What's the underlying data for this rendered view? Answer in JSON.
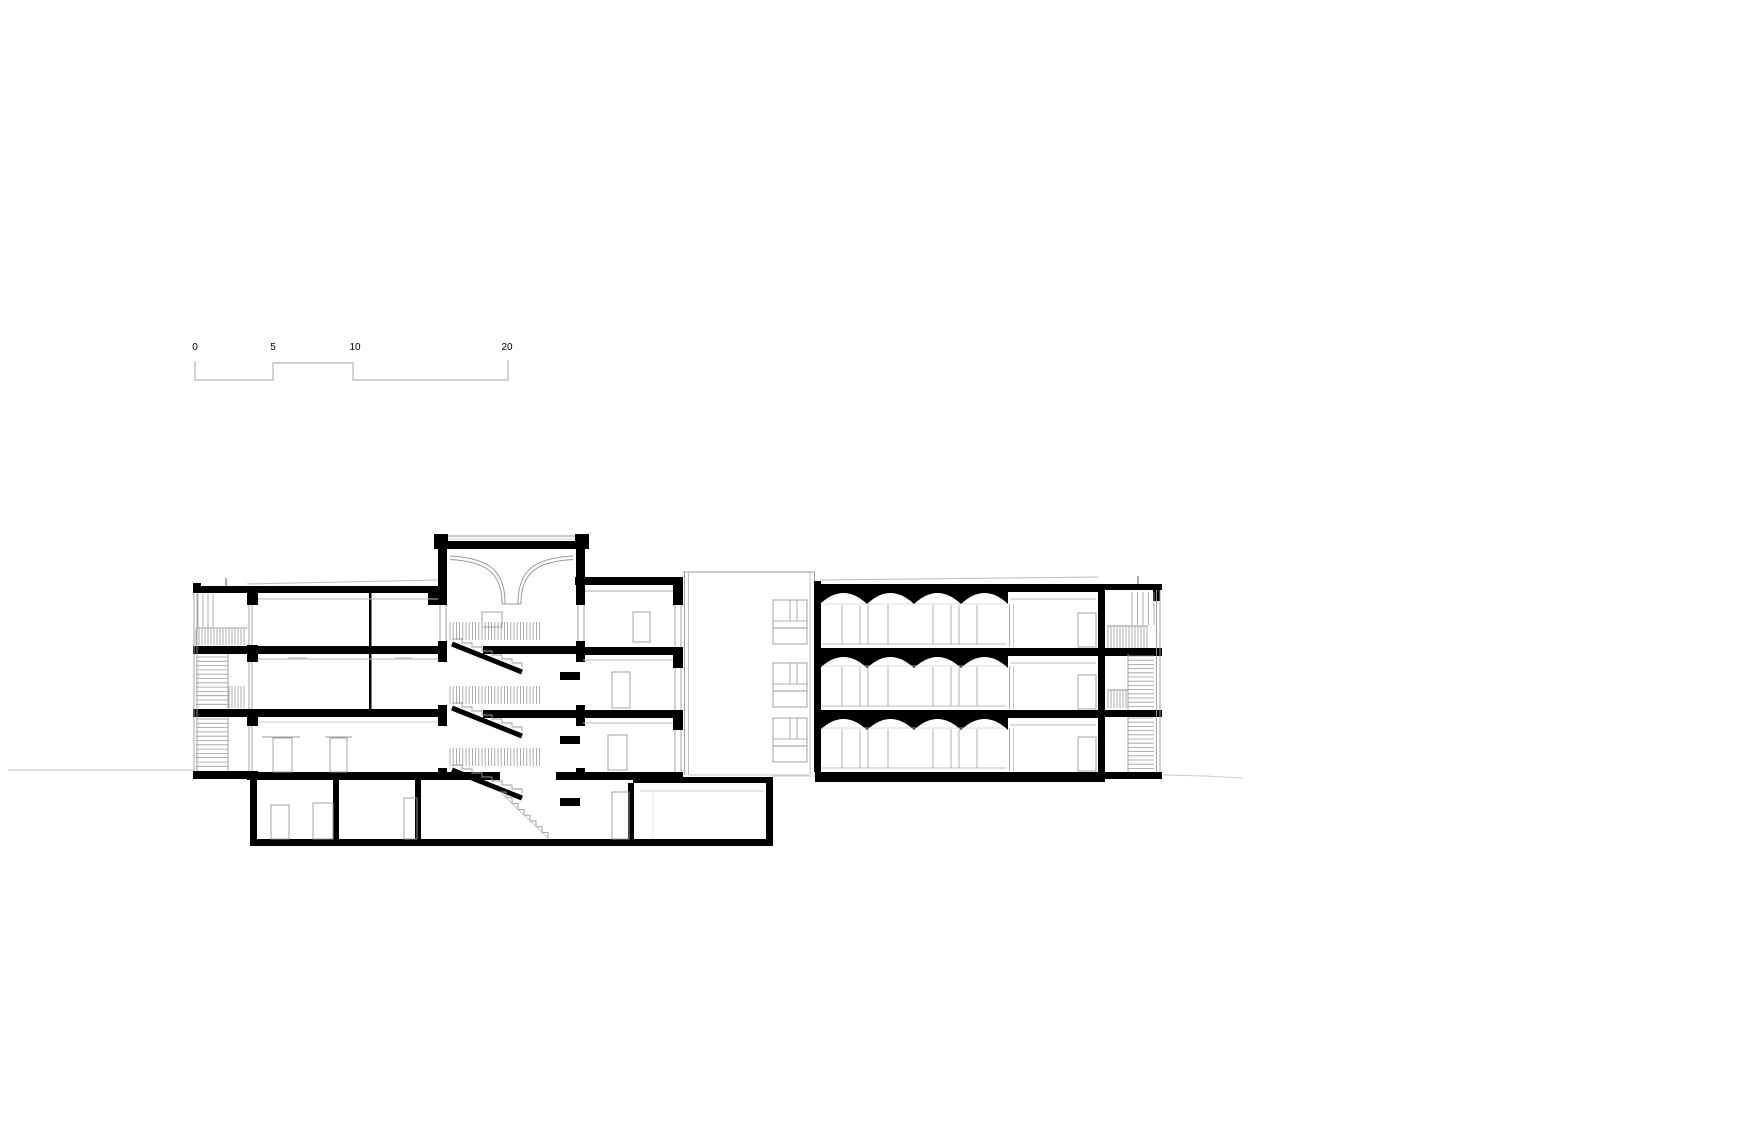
{
  "drawing": {
    "kind": "architectural longitudinal building section",
    "parts": [
      "left-escape-stair",
      "left-wing",
      "stair-tower",
      "middle-wing",
      "rear-connector",
      "right-wing",
      "right-escape-stair",
      "basement"
    ]
  },
  "scale_bar": {
    "labels": [
      "0",
      "5",
      "10",
      "20"
    ],
    "unit": "meters"
  },
  "colors": {
    "background": "#ffffff",
    "ink": "#000000",
    "line": "#9a9a9a",
    "faint": "#c6c6c6"
  }
}
